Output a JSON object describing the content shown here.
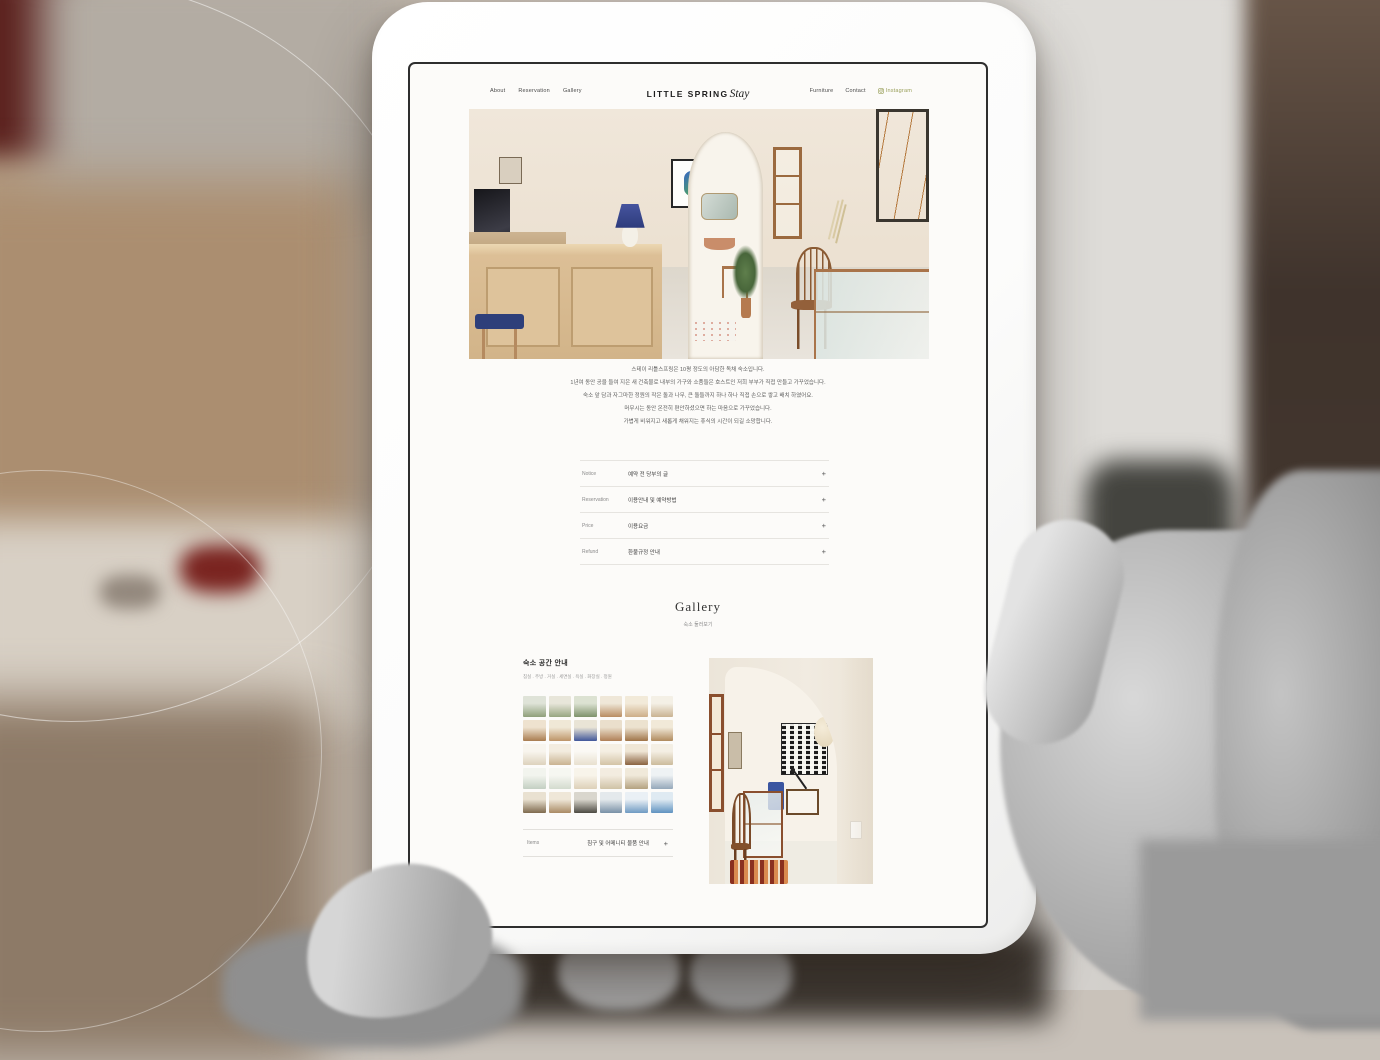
{
  "nav": {
    "left": [
      {
        "label": "About"
      },
      {
        "label": "Reservation"
      },
      {
        "label": "Gallery"
      }
    ],
    "logo": {
      "main": "LITTLE SPRING",
      "script": "Stay"
    },
    "right": [
      {
        "label": "Furniture"
      },
      {
        "label": "Contact"
      },
      {
        "label": "Instagram"
      }
    ],
    "instagram_color": "#9aa05c"
  },
  "intro": {
    "lines": [
      "스테이 리틀스프링은 10평 정도의 아담한 독채 숙소입니다.",
      "1년여 동안 공을 들여 지은 새 건축물로 내부의 가구와 소품들은 호스트인 저희 부부가 직접 만들고 가꾸었습니다.",
      "숙소 앞 담과 자그마한 정원의 작은 돌과 나무, 큰 돌들까지 하나 하나 직접 손으로 쌓고 배치 하였어요.",
      "머무시는 동안 온전히 편안하셨으면 하는 마음으로 가꾸었습니다.",
      "가볍게 비워지고 새롭게 채워지는 휴식의 시간이 되길 소망합니다."
    ]
  },
  "accordion": {
    "items": [
      {
        "label": "Notice",
        "value": "예약 전 당부의 글",
        "toggle": "+"
      },
      {
        "label": "Reservation",
        "value": "이용안내 및 예약방법",
        "toggle": "+"
      },
      {
        "label": "Price",
        "value": "이용요금",
        "toggle": "+"
      },
      {
        "label": "Refund",
        "value": "환불규정 안내",
        "toggle": "+"
      }
    ]
  },
  "gallery": {
    "title": "Gallery",
    "subtitle": "숙소 둘러보기",
    "space": {
      "heading": "숙소 공간 안내",
      "subheading": "침실 . 주방 . 거실 . 세면실 . 욕실 . 화장실 . 정원"
    },
    "items_row": {
      "label": "Items",
      "value": "침구 및 어메니티 물품 안내",
      "toggle": "+"
    },
    "thumbs": [
      {
        "top": "#dfe3d8",
        "bottom": "#8fa07a"
      },
      {
        "top": "#e8e6da",
        "bottom": "#97a681"
      },
      {
        "top": "#dce2d2",
        "bottom": "#7e926b"
      },
      {
        "top": "#efe7d8",
        "bottom": "#b98d62"
      },
      {
        "top": "#f2ead9",
        "bottom": "#cdae88"
      },
      {
        "top": "#f4f0e6",
        "bottom": "#c9b392"
      },
      {
        "top": "#eee2cf",
        "bottom": "#a97c50"
      },
      {
        "top": "#f0e8d6",
        "bottom": "#bd9468"
      },
      {
        "top": "#e9e4d6",
        "bottom": "#41579a"
      },
      {
        "top": "#eadfcc",
        "bottom": "#b07f57"
      },
      {
        "top": "#ece2cf",
        "bottom": "#9f7448"
      },
      {
        "top": "#f1e9d8",
        "bottom": "#b08a5e"
      },
      {
        "top": "#f8f5ee",
        "bottom": "#ddd2bd"
      },
      {
        "top": "#f3ecdf",
        "bottom": "#c9b391"
      },
      {
        "top": "#fbf9f4",
        "bottom": "#e8e0cf"
      },
      {
        "top": "#f5efe3",
        "bottom": "#d3c3a6"
      },
      {
        "top": "#efe6d5",
        "bottom": "#8a6340"
      },
      {
        "top": "#f4efe4",
        "bottom": "#cbbb9c"
      },
      {
        "top": "#f2f4ee",
        "bottom": "#c3cfc2"
      },
      {
        "top": "#f6f7f1",
        "bottom": "#d3dbce"
      },
      {
        "top": "#f8f4ea",
        "bottom": "#ddd0b8"
      },
      {
        "top": "#f3ece0",
        "bottom": "#cfc2a6"
      },
      {
        "top": "#f0e9da",
        "bottom": "#b4a280"
      },
      {
        "top": "#eef2f4",
        "bottom": "#95a8ba"
      },
      {
        "top": "#e9e1d1",
        "bottom": "#7e6a4e"
      },
      {
        "top": "#efe7d8",
        "bottom": "#a98a64"
      },
      {
        "top": "#d9d6cd",
        "bottom": "#4c4a42"
      },
      {
        "top": "#e4e9ec",
        "bottom": "#7890a6"
      },
      {
        "top": "#eaf0f5",
        "bottom": "#6f9ac2"
      },
      {
        "top": "#dfeaf2",
        "bottom": "#5f92c0"
      }
    ]
  }
}
